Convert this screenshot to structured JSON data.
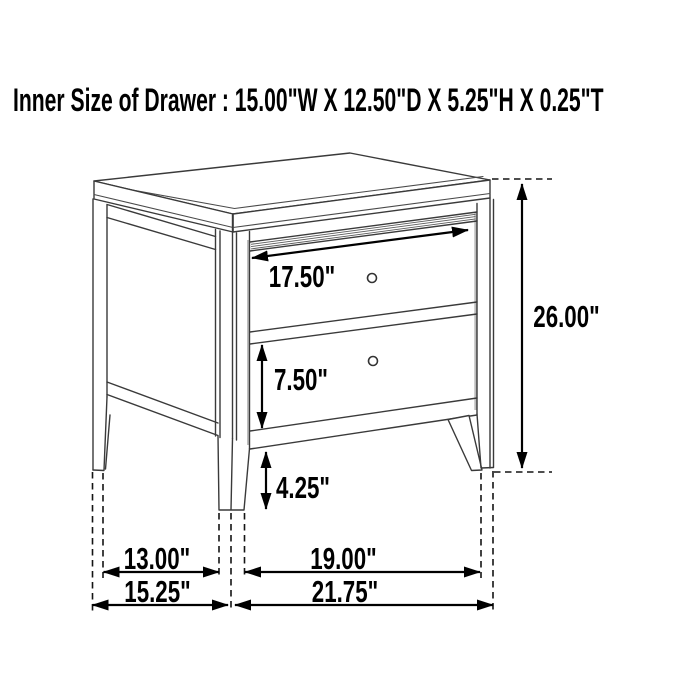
{
  "title": "Inner Size of Drawer : 15.00\"W X 12.50\"D X 5.25\"H X 0.25\"T",
  "figure": {
    "subject": "two-drawer nightstand",
    "style": "black-and-white line drawing with dimension arrows"
  },
  "labels": {
    "drawer_front_width": "17.50\"",
    "overall_height": "26.00\"",
    "lower_drawer_height": "7.50\"",
    "leg_height": "4.25\"",
    "side_leg_clear_span": "13.00\"",
    "front_leg_clear_span": "19.00\"",
    "overall_depth": "15.25\"",
    "overall_width": "21.75\""
  },
  "colors": {
    "background": "#ffffff",
    "artwork_line": "#3a3a3a",
    "dimension_line": "#000000",
    "text": "#000000"
  }
}
